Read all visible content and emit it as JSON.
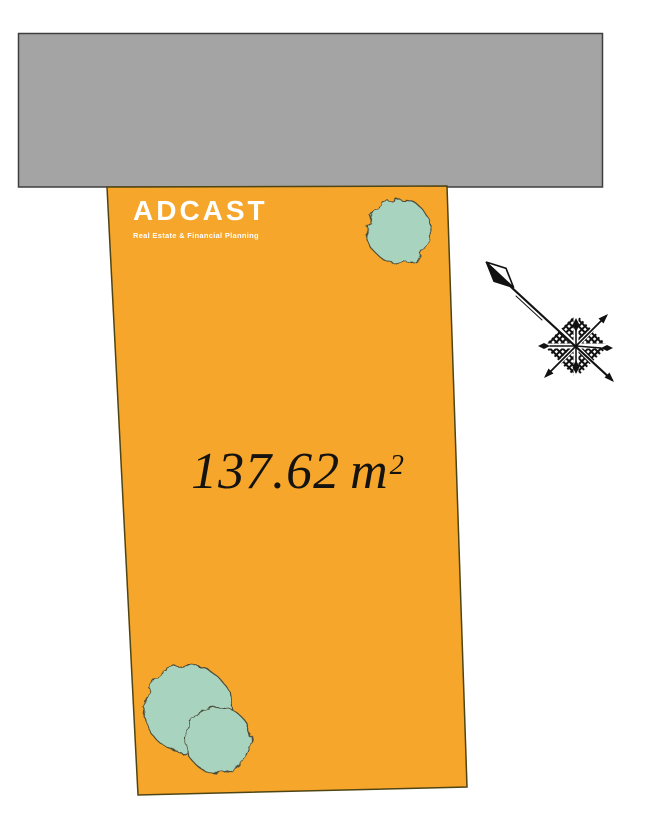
{
  "site_plan": {
    "road_block": {
      "color": "#A4A4A4",
      "outline_color": "#3F3F3F"
    },
    "parcel": {
      "color": "#F5A62B",
      "outline_color": "#4F4413",
      "area": {
        "value": "137.62",
        "unit": "m",
        "exponent": "2"
      }
    },
    "brand": {
      "name": "ADCAST",
      "tagline": "Real Estate & Financial Planning",
      "text_color": "#FFFFFF"
    },
    "trees": {
      "color": "#A8D4BF",
      "outline_color": "#4C4C38",
      "count": 3
    },
    "compass": {
      "color": "#111111"
    }
  }
}
